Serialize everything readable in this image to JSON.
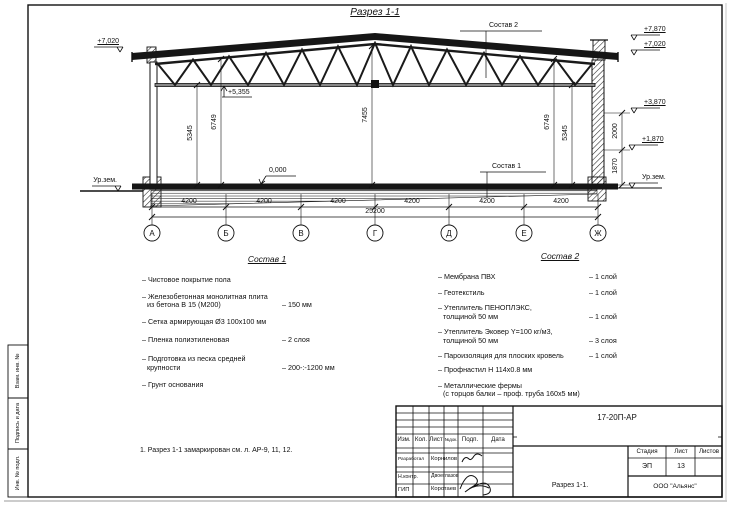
{
  "sheet": {
    "title": "Разрез 1-1",
    "note": "1. Разрез 1-1 замаркирован см. л. АР-9, 11, 12.",
    "margin_labels": {
      "b1": "Взам. инв. №",
      "b2": "Подпись и дата",
      "b3": "Инв. № подл."
    }
  },
  "elevations": {
    "left_roof": "+7,020",
    "left_ground": "Ур.зем.",
    "right_ridge": "+7,870",
    "right_eaves": "+7,020",
    "right_mid": "+3,870",
    "right_low": "+1,870",
    "right_ground": "Ур.зем.",
    "truss_bottom": "+5,355",
    "floor": "0,000"
  },
  "dims": {
    "spans": [
      "4200",
      "4200",
      "4200",
      "4200",
      "4200",
      "4200"
    ],
    "total": "25200",
    "v_left_inner": "5345",
    "v_left_outer": "6749",
    "v_center": "7455",
    "v_right_outer": "6749",
    "v_right_inner": "5345",
    "r_upper": "2000",
    "r_lower": "1870"
  },
  "axes": {
    "letters": [
      "А",
      "Б",
      "В",
      "Г",
      "Д",
      "Е",
      "Ж"
    ]
  },
  "callouts": {
    "c1": "Состав 1",
    "c2": "Состав 2"
  },
  "sostav1": {
    "title": "Состав 1",
    "items": [
      {
        "name": "– Чистовое покрытие пола",
        "name2": "",
        "value": ""
      },
      {
        "name": "– Железобетонная  монолитная плита",
        "name2": "из бетона В 15 (М200)",
        "value": "– 150 мм"
      },
      {
        "name": "– Сетка армирующая Ø3 100х100 мм",
        "name2": "",
        "value": ""
      },
      {
        "name": "– Пленка полиэтиленовая",
        "name2": "",
        "value": "– 2 слоя"
      },
      {
        "name": "– Подготовка из песка средней",
        "name2": "крупности",
        "value": "– 200-:-1200 мм"
      },
      {
        "name": "– Грунт основания",
        "name2": "",
        "value": ""
      }
    ]
  },
  "sostav2": {
    "title": "Состав 2",
    "items": [
      {
        "name": "– Мембрана ПВХ",
        "name2": "",
        "value": "– 1 слой"
      },
      {
        "name": "– Геотекстиль",
        "name2": "",
        "value": "– 1 слой"
      },
      {
        "name": "– Утеплитель ПЕНОПЛЭКС,",
        "name2": "толщиной 50 мм",
        "value": "– 1 слой"
      },
      {
        "name": "– Утеплитель Эковер Y=100 кг/м3,",
        "name2": "толщиной 50 мм",
        "value": "– 3 слоя"
      },
      {
        "name": "– Пароизоляция для плоских кровель",
        "name2": "",
        "value": "– 1 слой"
      },
      {
        "name": "– Профнастил Н 114х0.8 мм",
        "name2": "",
        "value": ""
      },
      {
        "name": "– Металлические фермы",
        "name2": "(с торцов балки – проф. труба 160х5 мм)",
        "value": ""
      }
    ]
  },
  "titleblock": {
    "doc_code": "17-20П-АР",
    "cols": [
      "Изм.",
      "Кол.",
      "Лист",
      "№док.",
      "Подп.",
      "Дата"
    ],
    "rows": [
      {
        "role": "Разработал",
        "name": "Корнилов"
      },
      {
        "role": "Н.контр.",
        "name": "Двоеглазов"
      },
      {
        "role": "ГИП",
        "name": "Коротаев"
      }
    ],
    "stage_label": "Стадия",
    "sheet_label": "Лист",
    "sheets_label": "Листов",
    "stage": "ЭП",
    "sheet_no": "13",
    "sheets_total": "",
    "drawing_name": "Разрез 1-1.",
    "company": "ООО \"Альянс\""
  }
}
